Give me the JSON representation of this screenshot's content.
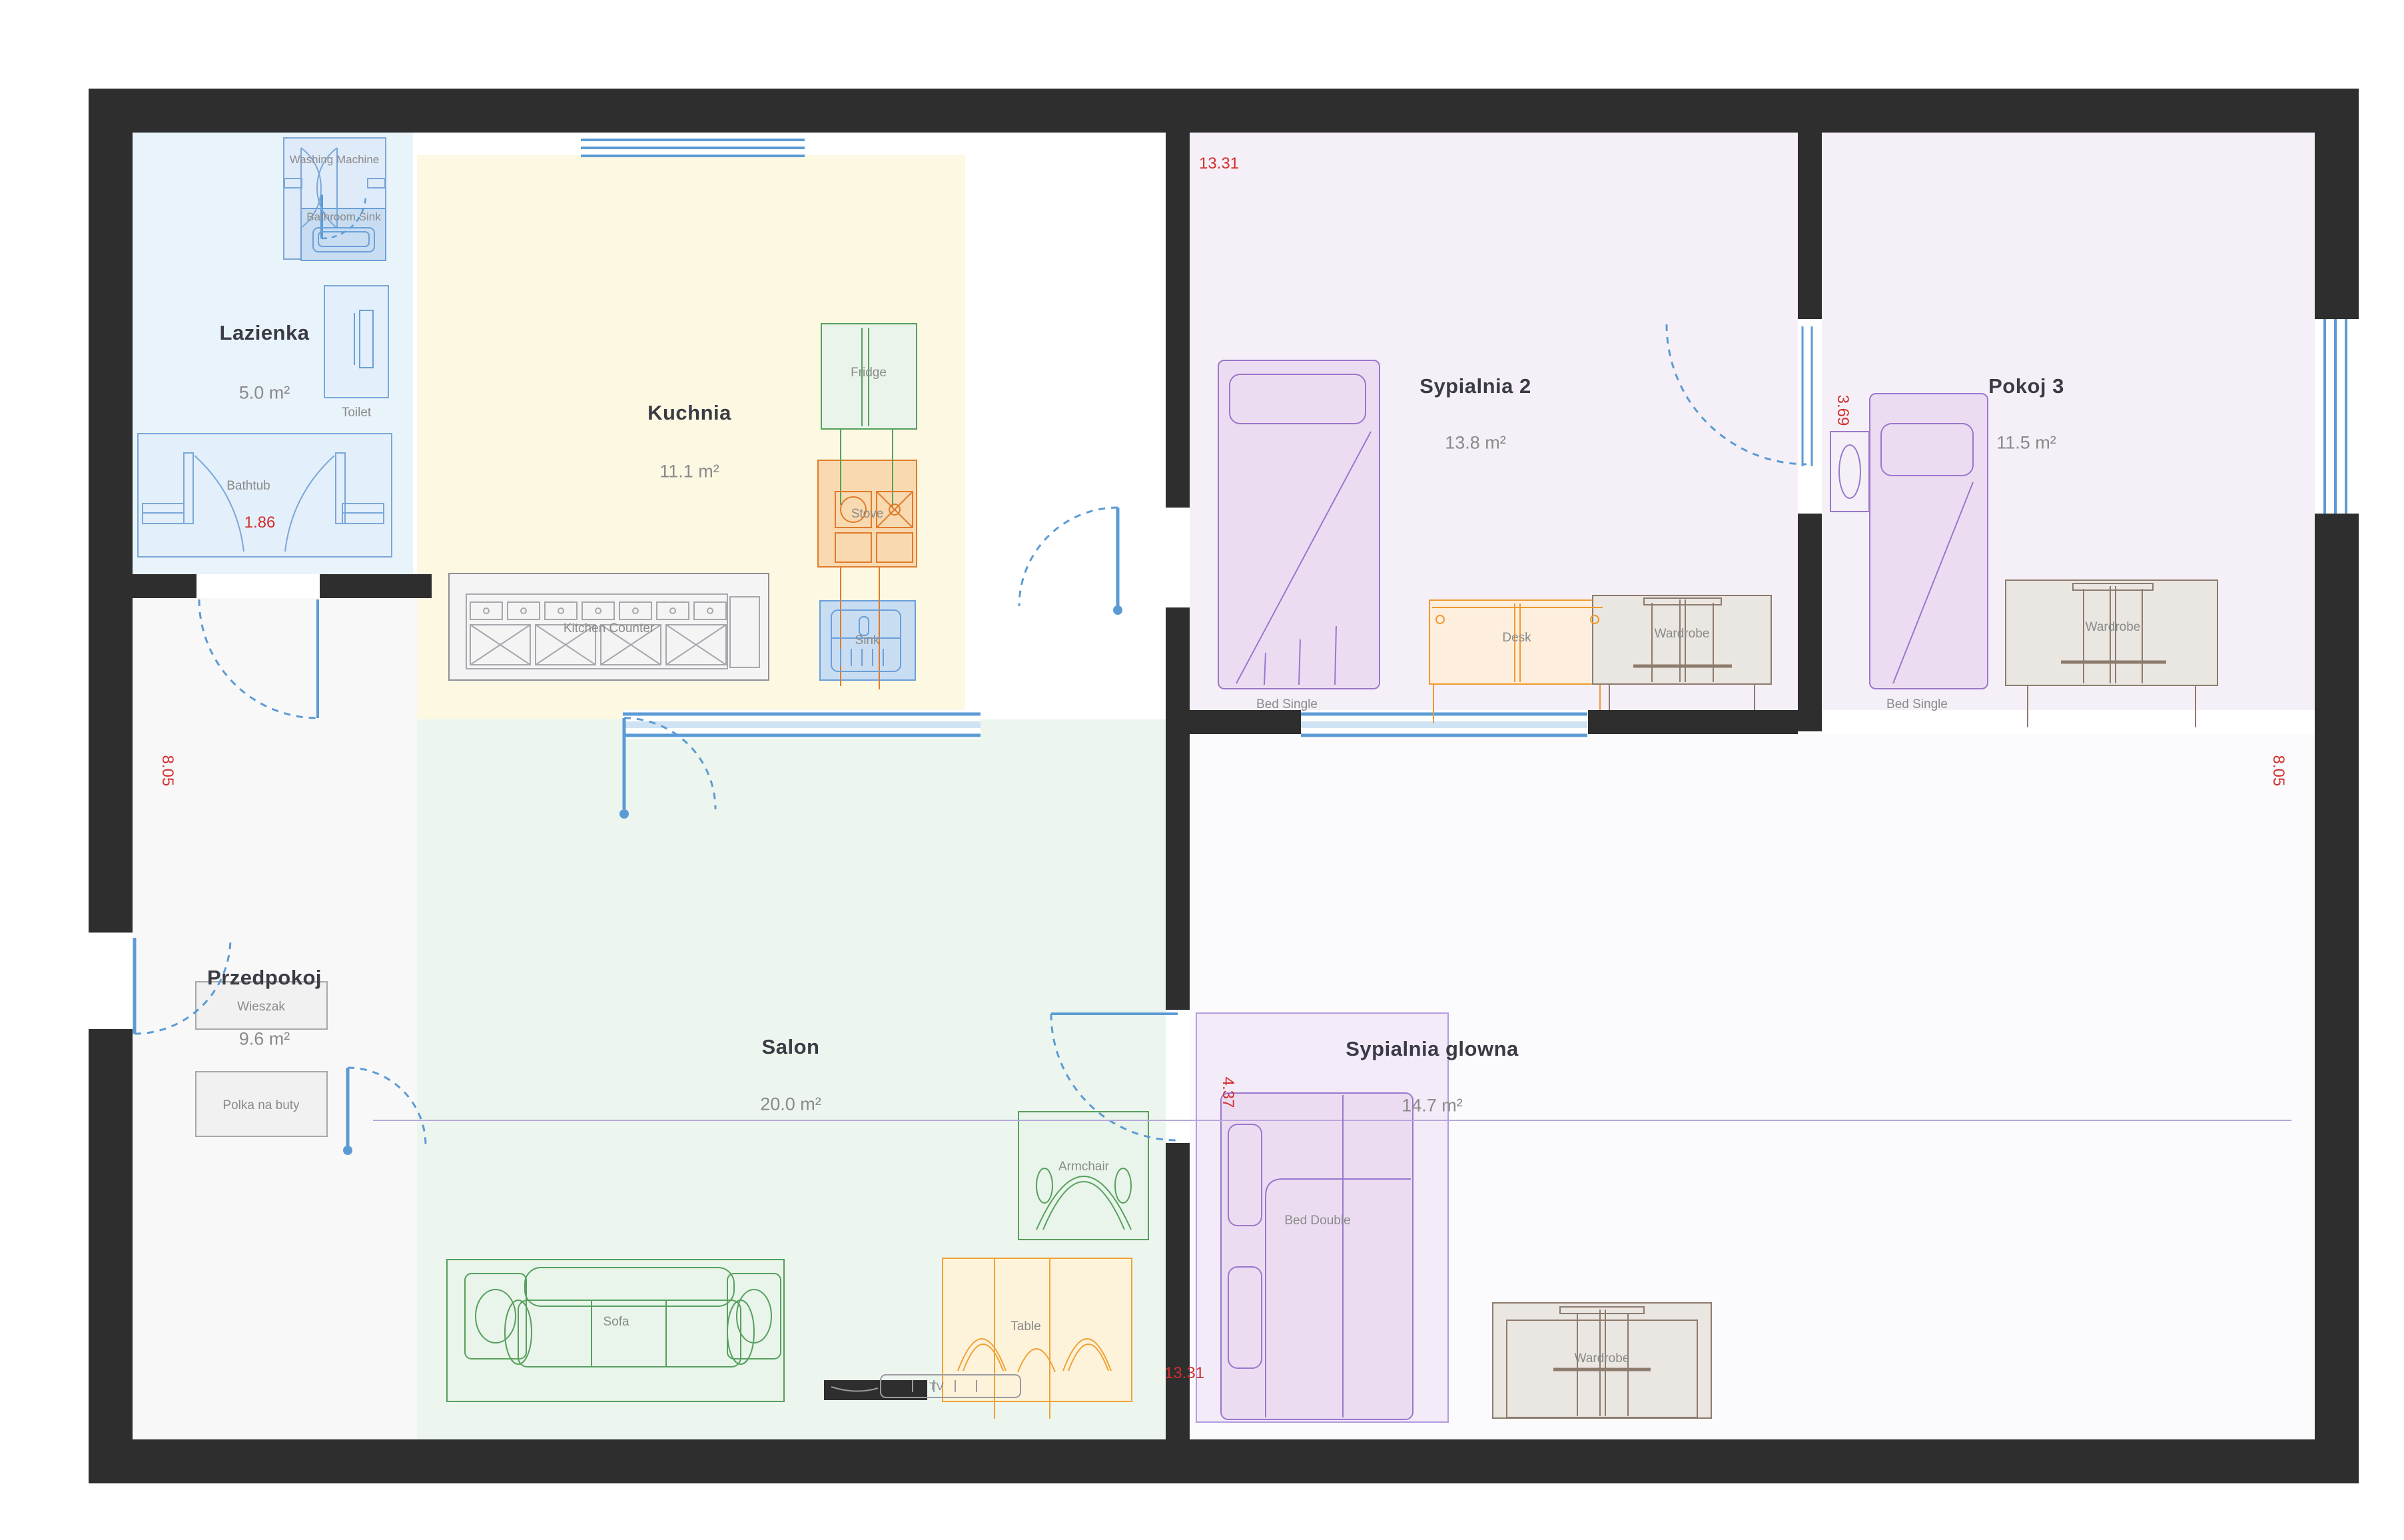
{
  "rooms": [
    {
      "name": "Lazienka",
      "area": "5.0 m²"
    },
    {
      "name": "Kuchnia",
      "area": "11.1 m²"
    },
    {
      "name": "Salon",
      "area": "20.0 m²"
    },
    {
      "name": "Przedpokoj",
      "area": "9.6 m²"
    },
    {
      "name": "Sypialnia 2",
      "area": "13.8 m²"
    },
    {
      "name": "Pokoj 3",
      "area": "11.5 m²"
    },
    {
      "name": "Sypialnia glowna",
      "area": "14.7 m²"
    }
  ],
  "furniture": {
    "washing_machine": "Washing Machine",
    "bathroom_sink": "Bathroom Sink",
    "toilet": "Toilet",
    "bathtub": "Bathtub",
    "fridge": "Fridge",
    "stove": "Stove",
    "kitchen_sink": "Sink",
    "kitchen_counter": "Kitchen Counter",
    "wieszak": "Wieszak",
    "polka_na_buty": "Polka na buty",
    "sofa": "Sofa",
    "armchair": "Armchair",
    "table": "Table",
    "tv": "TV",
    "bed_single_s2": "Bed Single",
    "desk": "Desk",
    "wardrobe_s2": "Wardrobe",
    "bed_single_p3": "Bed Single",
    "wardrobe_p3": "Wardrobe",
    "bed_double": "Bed Double",
    "wardrobe_master": "Wardrobe"
  },
  "dimensions": {
    "top": "13.31",
    "bottom": "13.31",
    "left": "8.05",
    "right": "8.05",
    "bathtub": "1.86",
    "pokoj3": "3.69",
    "master": "4.37"
  },
  "colors": {
    "wall": "#2e2e2e",
    "dimension_red": "#d32f2f",
    "door_blue": "#5b9bd5",
    "room_border_purple": "#b49be0"
  }
}
